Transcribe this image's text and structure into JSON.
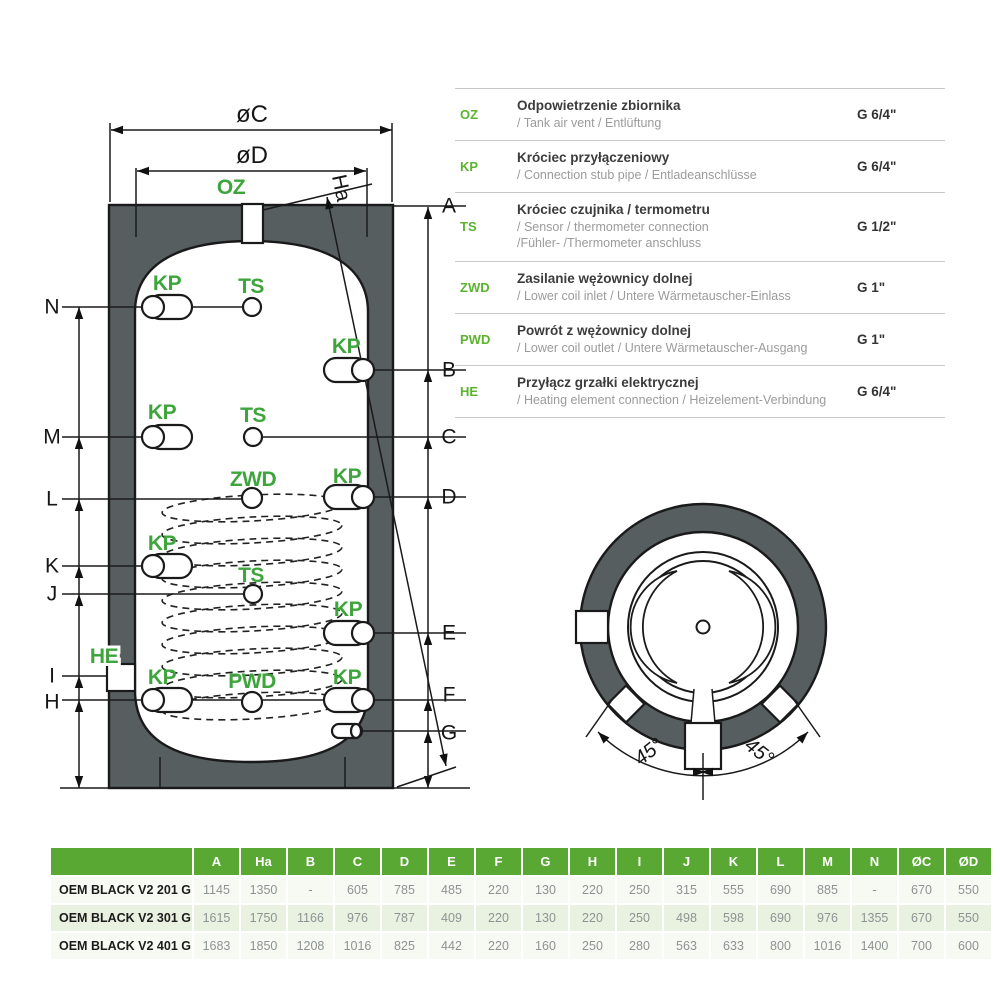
{
  "diagram": {
    "dim_labels": {
      "oc": "øC",
      "od": "øD",
      "ha": "Ha",
      "a": "A",
      "b": "B",
      "c": "C",
      "d": "D",
      "e": "E",
      "f": "F",
      "g": "G",
      "h": "H",
      "i": "I",
      "j": "J",
      "k": "K",
      "l": "L",
      "m": "M",
      "n": "N"
    },
    "port_labels": {
      "oz": "OZ",
      "kp": "KP",
      "ts": "TS",
      "zwd": "ZWD",
      "pwd": "PWD",
      "he": "HE"
    }
  },
  "top_view": {
    "angle_left": "45°",
    "angle_right": "45°"
  },
  "legend": {
    "rows": [
      {
        "abbr": "OZ",
        "title": "Odpowietrzenie zbiornika",
        "subtitle": "/ Tank air vent / Entlüftung",
        "size": "G 6/4\""
      },
      {
        "abbr": "KP",
        "title": "Króciec przyłączeniowy",
        "subtitle": "/ Connection stub pipe / Entladeanschlüsse",
        "size": "G 6/4\""
      },
      {
        "abbr": "TS",
        "title": "Króciec czujnika / termometru",
        "subtitle": "/ Sensor / thermometer connection\n/Fühler- /Thermometer anschluss",
        "size": "G 1/2\""
      },
      {
        "abbr": "ZWD",
        "title": "Zasilanie wężownicy dolnej",
        "subtitle": "/ Lower coil inlet / Untere Wärmetauscher-Einlass",
        "size": "G 1\""
      },
      {
        "abbr": "PWD",
        "title": "Powrót z wężownicy dolnej",
        "subtitle": "/ Lower coil outlet / Untere Wärmetauscher-Ausgang",
        "size": "G 1\""
      },
      {
        "abbr": "HE",
        "title": "Przyłącz grzałki elektrycznej",
        "subtitle": "/ Heating element connection / Heizelement-Verbindung",
        "size": "G 6/4\""
      }
    ]
  },
  "table": {
    "headers": [
      "A",
      "Ha",
      "B",
      "C",
      "D",
      "E",
      "F",
      "G",
      "H",
      "I",
      "J",
      "K",
      "L",
      "M",
      "N",
      "ØC",
      "ØD"
    ],
    "rows": [
      {
        "name": "OEM BLACK V2 201 G",
        "values": [
          "1145",
          "1350",
          "-",
          "605",
          "785",
          "485",
          "220",
          "130",
          "220",
          "250",
          "315",
          "555",
          "690",
          "885",
          "-",
          "670",
          "550"
        ]
      },
      {
        "name": "OEM BLACK V2 301 G",
        "values": [
          "1615",
          "1750",
          "1166",
          "976",
          "787",
          "409",
          "220",
          "130",
          "220",
          "250",
          "498",
          "598",
          "690",
          "976",
          "1355",
          "670",
          "550"
        ]
      },
      {
        "name": "OEM BLACK V2 401 G",
        "values": [
          "1683",
          "1850",
          "1208",
          "1016",
          "825",
          "442",
          "220",
          "160",
          "250",
          "280",
          "563",
          "633",
          "800",
          "1016",
          "1400",
          "700",
          "600"
        ]
      }
    ]
  },
  "colors": {
    "accent_green": "#5aa834",
    "label_green": "#3ea43c",
    "insulation_gray": "#565e60"
  }
}
